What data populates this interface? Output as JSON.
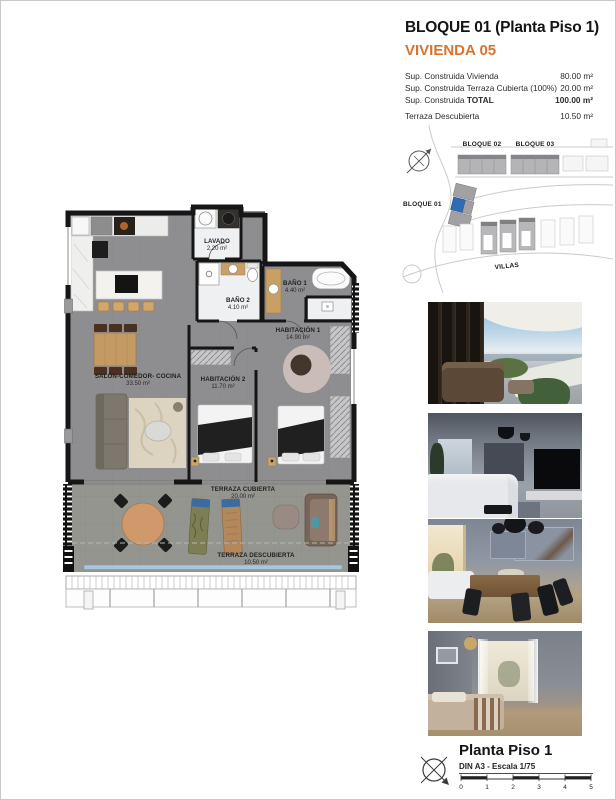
{
  "header": {
    "title": "BLOQUE 01  (Planta Piso 1)",
    "unit": "VIVIENDA 05",
    "accent_color": "#d8732e",
    "areas": [
      {
        "label": "Sup. Construida Vivienda",
        "label_bold": "",
        "value": "80.00 m²"
      },
      {
        "label": "Sup. Construida Terraza Cubierta (100%)",
        "label_bold": "",
        "value": "20.00 m²"
      },
      {
        "label": "Sup. Construida ",
        "label_bold": "TOTAL",
        "value": "100.00 m²"
      },
      {
        "label": "Terraza Descubierta",
        "label_bold": "",
        "value": "10.50 m²"
      }
    ]
  },
  "site_plan": {
    "bloque01": "BLOQUE 01",
    "bloque02": "BLOQUE 02",
    "bloque03": "BLOQUE 03",
    "villas": "VILLAS",
    "highlight_color": "#2f6cb0",
    "icons": {
      "compass": "north-arrow-compass"
    }
  },
  "floor_plan": {
    "rooms": [
      {
        "name": "LAVADO",
        "area": "2.20 m²"
      },
      {
        "name": "BAÑO 2",
        "area": "4.10 m²"
      },
      {
        "name": "BAÑO 1",
        "area": "4.40 m²"
      },
      {
        "name": "HABITACIÓN 1",
        "area": "14.90 m²"
      },
      {
        "name": "HABITACIÓN 2",
        "area": "11.70 m²"
      },
      {
        "name": "SALÓN-COMEDOR- COCINA",
        "area": "33.50 m²"
      },
      {
        "name": "TERRAZA CUBIERTA",
        "area": "20.00 m²"
      },
      {
        "name": "TERRAZA DESCUBIERTA",
        "area": "10.50 m²"
      }
    ],
    "glass_color": "#a9c6dc"
  },
  "photos": [
    {
      "name": "terrace-exterior-render"
    },
    {
      "name": "living-room-render"
    },
    {
      "name": "dining-room-render"
    },
    {
      "name": "bedroom-render"
    }
  ],
  "footer": {
    "title": "Planta Piso 1",
    "scale_note": "DIN A3 - Escala 1/75",
    "ticks": [
      "0",
      "1",
      "2",
      "3",
      "4",
      "5"
    ],
    "icons": {
      "compass": "north-arrow-compass"
    }
  }
}
